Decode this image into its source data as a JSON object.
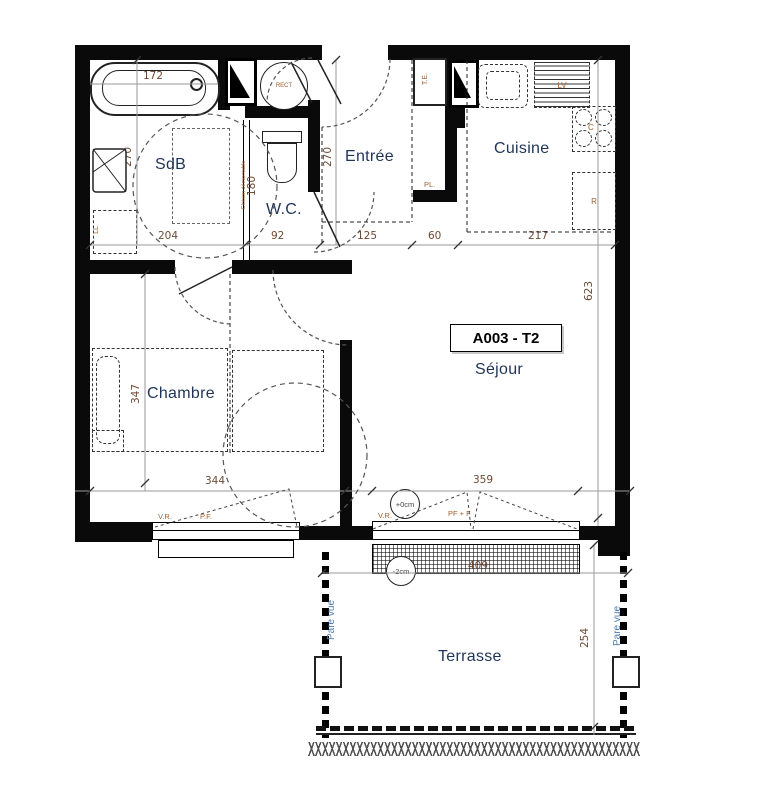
{
  "title": "A003 - T2",
  "colors": {
    "wall": "#0a0a0a",
    "room_label": "#1f3457",
    "dimension": "#6e4a35",
    "annotation": "#a2602e",
    "pare_vue": "#4f79ad"
  },
  "rooms": {
    "sdb": "SdB",
    "wc": "W.C.",
    "entree": "Entrée",
    "cuisine": "Cuisine",
    "chambre": "Chambre",
    "sejour": "Séjour",
    "terrasse": "Terrasse"
  },
  "dimensions": {
    "bathtub_length": "172",
    "sdb_width": "204",
    "wc_width": "92",
    "entree_width": "125",
    "closet_width": "60",
    "cuisine_width": "217",
    "sdb_depth": "270",
    "wc_depth": "180",
    "entree_depth": "270",
    "sejour_depth": "623",
    "chambre_depth": "347",
    "chambre_width": "344",
    "sejour_window_width": "359",
    "terrasse_width": "409",
    "terrasse_depth": "254"
  },
  "fixtures": {
    "water_heater": "RECT",
    "washing_machine": "LL",
    "electrical_panel": "T.E.",
    "closet": "PL.",
    "dishwasher": "LV",
    "cooktop": "C",
    "fridge": "R"
  },
  "openings": {
    "chambre_shutter": "V.R.",
    "chambre_window": "P.F.",
    "sejour_shutter": "V.R.",
    "sejour_window": "PF + F",
    "level_inside": "+0cm",
    "level_outside": "-2cm"
  },
  "annotations": {
    "partition": "Cloison démontable",
    "pare_vue_left": "Pare vue",
    "pare_vue_right": "Pare vue"
  }
}
